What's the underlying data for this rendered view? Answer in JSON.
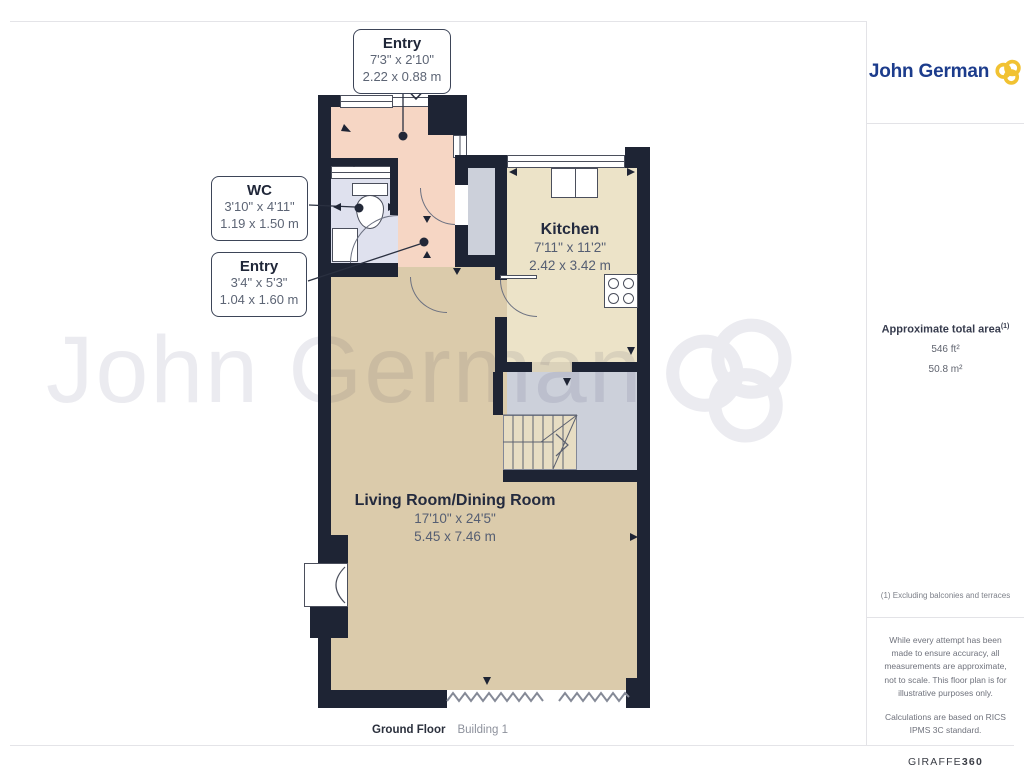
{
  "branding": {
    "agency_name": "John German",
    "watermark_text": "John German",
    "brand_navy": "#1c3c8c",
    "brand_yellow": "#f1c232"
  },
  "sidebar": {
    "area": {
      "label": "Approximate total area",
      "footnote_marker": "(1)",
      "value_imperial": "546 ft²",
      "value_metric": "50.8 m²"
    },
    "footnote": "(1) Excluding balconies and terraces",
    "disclaimer1": "While every attempt has been made to ensure accuracy, all measurements are approximate, not to scale. This floor plan is for illustrative purposes only.",
    "disclaimer2": "Calculations are based on RICS IPMS 3C standard.",
    "provider": {
      "name": "GIRAFFE",
      "suffix": "360"
    }
  },
  "footer": {
    "floor_label": "Ground Floor",
    "building_label": "Building 1"
  },
  "floorplan": {
    "rooms": [
      {
        "name": "Kitchen",
        "imperial": "7'11\" x 11'2\"",
        "metric": "2.42 x 3.42 m"
      },
      {
        "name": "Living Room/Dining Room",
        "imperial": "17'10\" x 24'5\"",
        "metric": "5.45 x 7.46 m"
      }
    ],
    "callouts": [
      {
        "name": "Entry",
        "imperial": "7'3\" x 2'10\"",
        "metric": "2.22 x 0.88 m"
      },
      {
        "name": "WC",
        "imperial": "3'10\" x 4'11\"",
        "metric": "1.19 x 1.50 m"
      },
      {
        "name": "Entry",
        "imperial": "3'4\" x 5'3\"",
        "metric": "1.04 x 1.60 m"
      }
    ],
    "colors": {
      "wall": "#1e2434",
      "entry": "#f6d6c4",
      "wc": "#dfe1ee",
      "kitchen": "#ece3c8",
      "living": "#dbcbab",
      "circulation": "#ccd0da",
      "stairs": "#e7ddc3"
    }
  }
}
